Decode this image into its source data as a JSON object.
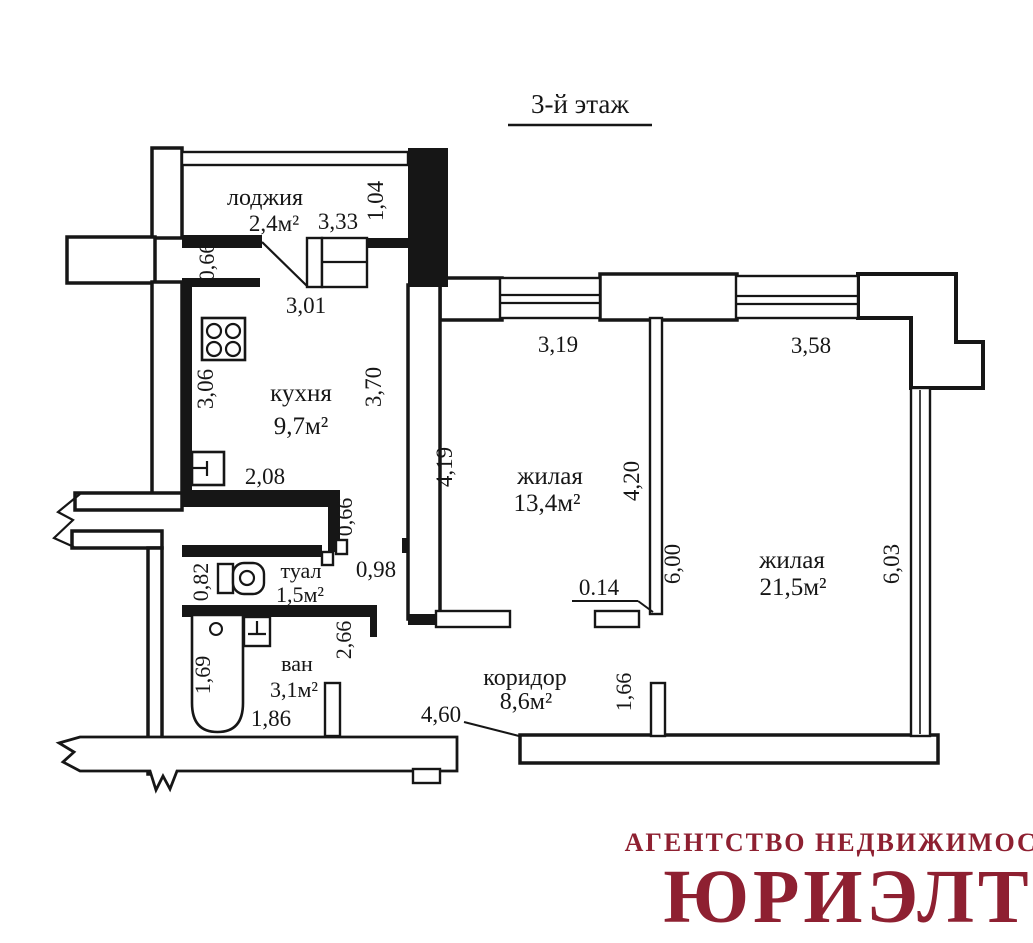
{
  "title": "3-й этаж",
  "rooms": {
    "loggia": {
      "name": "лоджия",
      "area": "2,4м²"
    },
    "kitchen": {
      "name": "кухня",
      "area": "9,7м²"
    },
    "living1": {
      "name": "жилая",
      "area": "13,4м²"
    },
    "living2": {
      "name": "жилая",
      "area": "21,5м²"
    },
    "wc": {
      "name": "туал",
      "area": "1,5м²"
    },
    "bath": {
      "name": "ван",
      "area": "3,1м²"
    },
    "corridor": {
      "name": "коридор",
      "area": "8,6м²"
    }
  },
  "dims": {
    "loggia_depth": "1,04",
    "loggia_width": "3,33",
    "loggia_offset": "0,66",
    "kitchen_top": "3,01",
    "kitchen_left": "3,06",
    "kitchen_right": "3,70",
    "kitchen_bottom": "2,08",
    "hall_wall": "0,66",
    "hall_door": "0,98",
    "wc_left": "0,82",
    "bath_right": "2,66",
    "bath_left": "1,69",
    "bath_width": "1,86",
    "window1": "3,19",
    "window2": "3,58",
    "room1_left": "4,19",
    "room1_right": "4,20",
    "partition_len": "6,00",
    "partition_thk": "0.14",
    "room2_right": "6,03",
    "corridor_len": "4,60",
    "corridor_door": "1,66"
  },
  "logo": {
    "line1": "АГЕНТСТВО НЕДВИЖИМОСТИ",
    "line2": "ЮРИЭЛТ",
    "color": "#8e2031"
  },
  "colors": {
    "ink": "#161616",
    "background": "#ffffff"
  }
}
